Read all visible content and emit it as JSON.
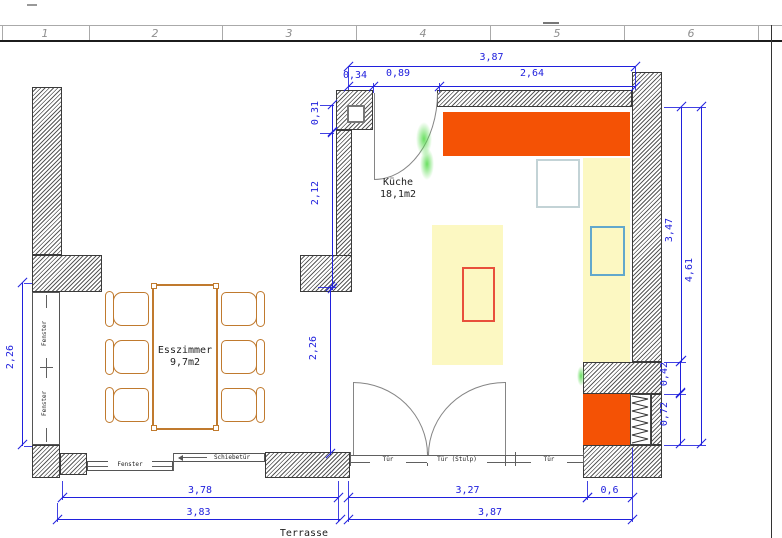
{
  "ruler": {
    "cells": [
      "1",
      "2",
      "3",
      "4",
      "5",
      "6"
    ]
  },
  "rooms": {
    "kitchen": {
      "name": "Küche",
      "area": "18,1m2"
    },
    "dining": {
      "name": "Esszimmer",
      "area": "9,7m2"
    }
  },
  "dims": {
    "top_overall": "3,87",
    "top_seg_a": "0,34",
    "top_seg_b": "0,89",
    "top_seg_c": "2,64",
    "nw_seg_a": "0,31",
    "nw_seg_b": "2,12",
    "passage": "2,26",
    "west_window": "2,26",
    "east_inner": "3,47",
    "east_outer": "4,61",
    "east_seg_a": "0,42",
    "east_seg_b": "0,72",
    "south_west_inner": "3,78",
    "south_west_outer": "3,83",
    "south_east_inner": "3,27",
    "south_east_corner": "0,6",
    "south_east_outer": "3,87"
  },
  "labels": {
    "window_side_upper": "Fenster",
    "window_side_lower": "Fenster",
    "window_bottom": "Fenster",
    "sliding_door": "Schiebetür",
    "door_left": "Tür",
    "door_middle": "Tür (Stulp)",
    "door_right": "Tür",
    "terrace": "Terrasse"
  },
  "colors": {
    "counter_orange": "#f45205",
    "furniture_yellow": "#fcf8c2",
    "dimension_blue": "#2020dd",
    "hob_red": "#e8503c",
    "sink_blue": "#62a8cc",
    "appliance_gray": "#c3d3d6",
    "wood_orange": "#c07a2e",
    "selection_green": "#5adc50"
  }
}
